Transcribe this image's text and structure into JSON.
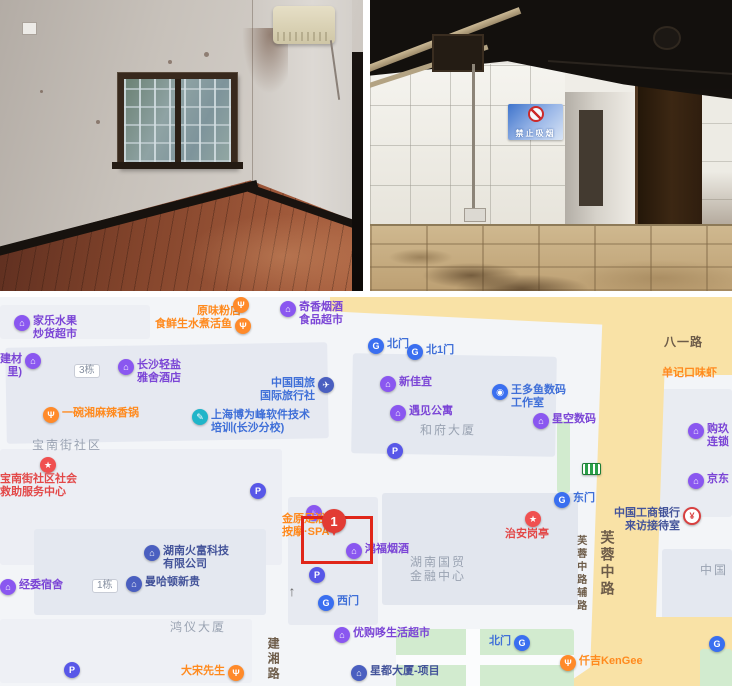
{
  "photos": {
    "right": {
      "sign_text": "禁止吸烟"
    }
  },
  "map": {
    "marker": {
      "label": "1"
    },
    "palette": {
      "purple": "#7b45d6",
      "orange": "#ff8a1e",
      "blue": "#3f6fd8",
      "navy": "#44549a",
      "red": "#e34848",
      "gray": "#9aa3b2",
      "road": "#6d5c49",
      "highlight": "#e02619",
      "roadFill": "#f9e2a6",
      "greenFill": "#d2ebcf",
      "buildingFill": "#e4e8f0"
    },
    "icon_glyphs": {
      "shop": "⌂",
      "hotel": "⌂",
      "food": "Ψ",
      "gate": "G",
      "parking": "P",
      "camera": "◉",
      "travel": "✈",
      "training": "✎",
      "redstar": "★",
      "bank": "¥",
      "company": "⌂",
      "spa": "♨",
      "busstop": "",
      "arrow": "↑"
    },
    "pois": [
      {
        "lines": [
          "家乐水果",
          "炒货超市"
        ],
        "x": 14,
        "y": 18,
        "icon": "shop",
        "color": "purple"
      },
      {
        "label": "原味粉店",
        "x": 197,
        "y": 8,
        "color": "orange"
      },
      {
        "label": "",
        "x": 233,
        "y": 0,
        "icon": "food"
      },
      {
        "label": "食鲜生水煮活鱼",
        "x": 155,
        "y": 21,
        "icon": "food",
        "pos": "left",
        "color": "orange"
      },
      {
        "lines": [
          "奇香烟酒",
          "食品超市"
        ],
        "x": 280,
        "y": 4,
        "icon": "shop",
        "color": "purple"
      },
      {
        "lines": [
          "建材",
          "里)"
        ],
        "x": 0,
        "y": 56,
        "icon": "shop",
        "pos": "left",
        "color": "purple"
      },
      {
        "label": "3栋",
        "x": 74,
        "y": 67,
        "icon": "badge"
      },
      {
        "lines": [
          "长沙轻盐",
          "雅舍酒店"
        ],
        "x": 118,
        "y": 62,
        "icon": "hotel",
        "color": "purple"
      },
      {
        "lines": [
          "中国国旅",
          "国际旅行社"
        ],
        "x": 260,
        "y": 80,
        "icon": "travel",
        "pos": "left",
        "color": "blue"
      },
      {
        "label": "一碗湘麻辣香锅",
        "x": 43,
        "y": 110,
        "icon": "food",
        "color": "orange"
      },
      {
        "lines": [
          "上海博为峰软件技术",
          "培训(长沙分校)"
        ],
        "x": 192,
        "y": 112,
        "icon": "training",
        "color": "blue"
      },
      {
        "label": "宝南街社区",
        "x": 32,
        "y": 141,
        "kind": "area"
      },
      {
        "label": "",
        "x": 40,
        "y": 160,
        "icon": "redstar"
      },
      {
        "lines": [
          "宝南街社区社会",
          "救助服务中心"
        ],
        "x": 0,
        "y": 176,
        "color": "red"
      },
      {
        "label": "",
        "x": 250,
        "y": 186,
        "icon": "parking"
      },
      {
        "label": "北门",
        "x": 368,
        "y": 41,
        "icon": "gate",
        "color": "blue"
      },
      {
        "label": "北1门",
        "x": 407,
        "y": 47,
        "icon": "gate",
        "color": "blue"
      },
      {
        "label": "新佳宜",
        "x": 380,
        "y": 79,
        "icon": "shop",
        "color": "purple"
      },
      {
        "lines": [
          "王多鱼数码",
          "工作室"
        ],
        "x": 492,
        "y": 87,
        "icon": "camera",
        "color": "blue"
      },
      {
        "label": "遇见公寓",
        "x": 390,
        "y": 108,
        "icon": "hotel",
        "color": "purple"
      },
      {
        "label": "星空数码",
        "x": 533,
        "y": 116,
        "icon": "shop",
        "color": "purple"
      },
      {
        "label": "和府大厦",
        "x": 420,
        "y": 126,
        "kind": "area"
      },
      {
        "label": "",
        "x": 387,
        "y": 146,
        "icon": "parking"
      },
      {
        "label": "八一路",
        "x": 664,
        "y": 38,
        "kind": "road"
      },
      {
        "label": "单记口味虾",
        "x": 662,
        "y": 70,
        "color": "orange"
      },
      {
        "lines": [
          "购玖",
          "连锁"
        ],
        "x": 688,
        "y": 126,
        "icon": "shop",
        "color": "purple"
      },
      {
        "label": "京东",
        "x": 688,
        "y": 176,
        "icon": "shop",
        "color": "purple"
      },
      {
        "label": "",
        "x": 582,
        "y": 166,
        "icon": "busstop"
      },
      {
        "label": "东门",
        "x": 554,
        "y": 195,
        "icon": "gate",
        "color": "blue"
      },
      {
        "label": "",
        "x": 525,
        "y": 214,
        "icon": "redstar"
      },
      {
        "label": "治安岗亭",
        "x": 505,
        "y": 231,
        "color": "red"
      },
      {
        "lines": [
          "中国工商银行",
          "来访接待室"
        ],
        "x": 614,
        "y": 210,
        "icon": "bank",
        "pos": "left",
        "color": "navy"
      },
      {
        "label": "芙蓉中路辅路",
        "x": 574,
        "y": 238,
        "kind": "road",
        "vertical": true,
        "small": true
      },
      {
        "label": "芙蓉中路",
        "x": 599,
        "y": 233,
        "kind": "road",
        "vertical": true,
        "big": true
      },
      {
        "lines": [
          "湖南火富科技",
          "有限公司"
        ],
        "x": 144,
        "y": 248,
        "icon": "company",
        "color": "navy"
      },
      {
        "label": "经委宿舍",
        "x": 0,
        "y": 282,
        "icon": "shop",
        "color": "purple"
      },
      {
        "label": "1栋",
        "x": 92,
        "y": 282,
        "icon": "badge"
      },
      {
        "label": "曼哈顿新贵",
        "x": 126,
        "y": 279,
        "icon": "company",
        "color": "navy"
      },
      {
        "label": "",
        "x": 306,
        "y": 208,
        "icon": "spa"
      },
      {
        "lines": [
          "金原足浴",
          "按摩·SPA"
        ],
        "x": 282,
        "y": 216,
        "color": "orange"
      },
      {
        "label": "鸿福烟酒",
        "x": 346,
        "y": 246,
        "icon": "shop",
        "color": "purple"
      },
      {
        "label": "",
        "x": 309,
        "y": 270,
        "icon": "parking"
      },
      {
        "label": "西门",
        "x": 318,
        "y": 298,
        "icon": "gate",
        "color": "blue"
      },
      {
        "label": "",
        "x": 284,
        "y": 286,
        "icon": "arrow"
      },
      {
        "lines": [
          "湖南国贸",
          "金融中心"
        ],
        "x": 410,
        "y": 258,
        "kind": "area"
      },
      {
        "label": "鸿仪大厦",
        "x": 170,
        "y": 323,
        "kind": "area"
      },
      {
        "label": "建湘路",
        "x": 266,
        "y": 340,
        "kind": "road",
        "vertical": true
      },
      {
        "label": "大宋先生",
        "x": 181,
        "y": 368,
        "icon": "food",
        "pos": "left",
        "color": "orange"
      },
      {
        "label": "",
        "x": 64,
        "y": 365,
        "icon": "parking"
      },
      {
        "label": "优购哆生活超市",
        "x": 334,
        "y": 330,
        "icon": "shop",
        "color": "purple"
      },
      {
        "label": "星都大厦-项目",
        "x": 351,
        "y": 368,
        "icon": "company",
        "color": "navy"
      },
      {
        "label": "北门",
        "x": 489,
        "y": 338,
        "icon": "gate",
        "pos": "left",
        "color": "blue"
      },
      {
        "label": "仟吉KenGee",
        "x": 560,
        "y": 358,
        "icon": "food",
        "color": "orange"
      },
      {
        "label": "",
        "x": 709,
        "y": 339,
        "icon": "gate"
      },
      {
        "label": "中国",
        "x": 700,
        "y": 266,
        "kind": "area"
      }
    ]
  }
}
